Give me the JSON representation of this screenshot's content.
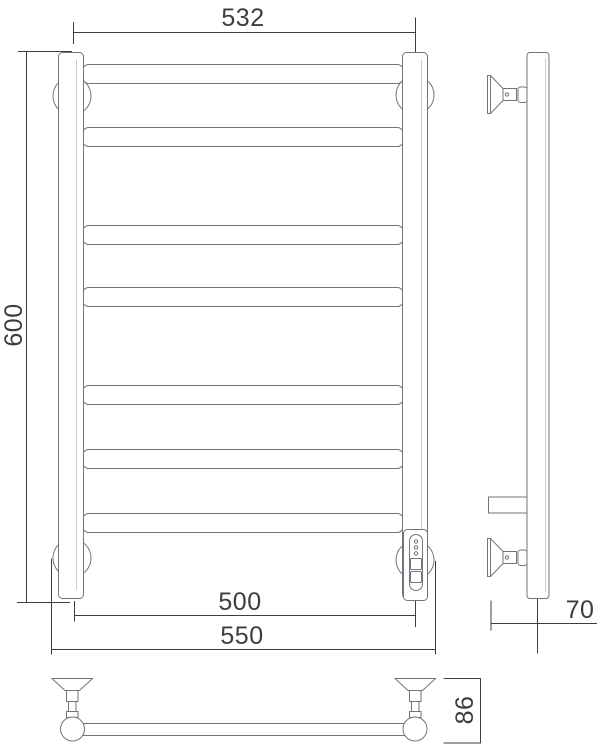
{
  "drawing": {
    "type": "technical-drawing",
    "subject": "Ladder-style heated towel rail, three-view dimensional drawing",
    "views": {
      "front": "front view",
      "side": "side view",
      "bottom": "plan view of rail with wall brackets"
    },
    "dimensions": {
      "top_width": "532",
      "height": "600",
      "inner_width": "500",
      "overall_width": "550",
      "wall_offset": "70",
      "bracket_depth": "86"
    },
    "front": {
      "rung_count": 7,
      "wall_bracket_count": 4,
      "has_controller": true
    },
    "colors": {
      "background": "#ffffff",
      "outline": "#71767c",
      "dimension_lines": "#3b3f44",
      "text": "#3a3e42",
      "highlight": "#c9cdd1"
    }
  }
}
